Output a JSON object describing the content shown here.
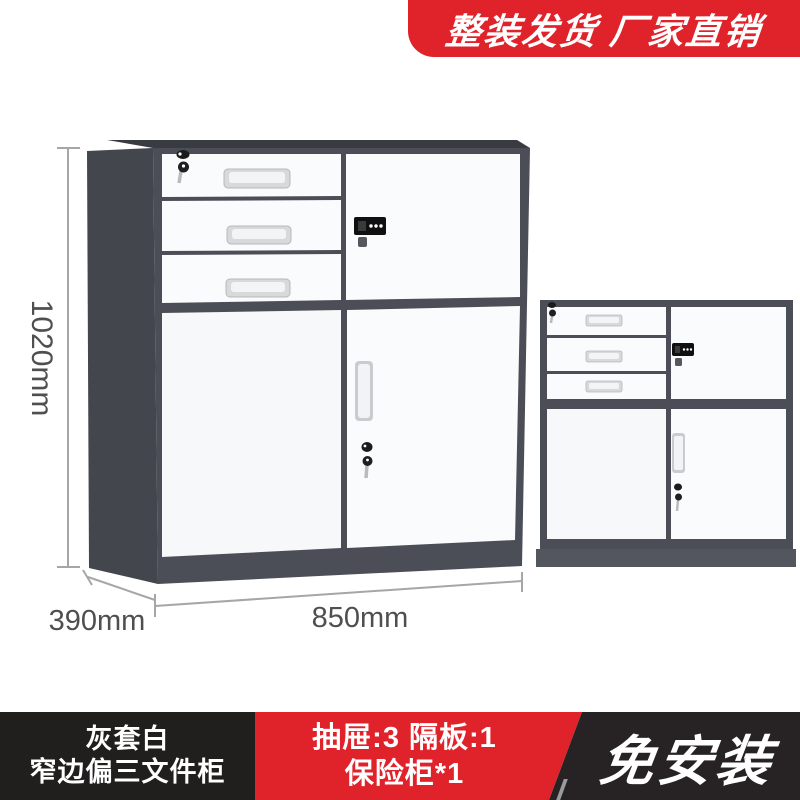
{
  "promo_banner": {
    "text": "整装发货 厂家直销",
    "bg_color": "#e0222a",
    "text_color": "#ffffff"
  },
  "illustration": {
    "dim_height": "1020mm",
    "dim_depth": "390mm",
    "dim_width": "850mm",
    "colors": {
      "cabinet_frame": "#4b4e56",
      "cabinet_side": "#43464d",
      "cabinet_top": "#383b42",
      "cabinet_panel": "#fafbfc",
      "cabinet_base": "#53565c",
      "dimension_line": "#a6a6a6",
      "dimension_text": "#4f4f4f"
    }
  },
  "info_bar": {
    "variant": {
      "line1": "灰套白",
      "line2": "窄边偏三文件柜",
      "bg_color": "#211e1e"
    },
    "config": {
      "line1": "抽屉:3 隔板:1",
      "line2": "保险柜*1",
      "bg_color": "#e0222a"
    },
    "highlight": {
      "text": "免安装",
      "bg_color": "#272324"
    }
  }
}
